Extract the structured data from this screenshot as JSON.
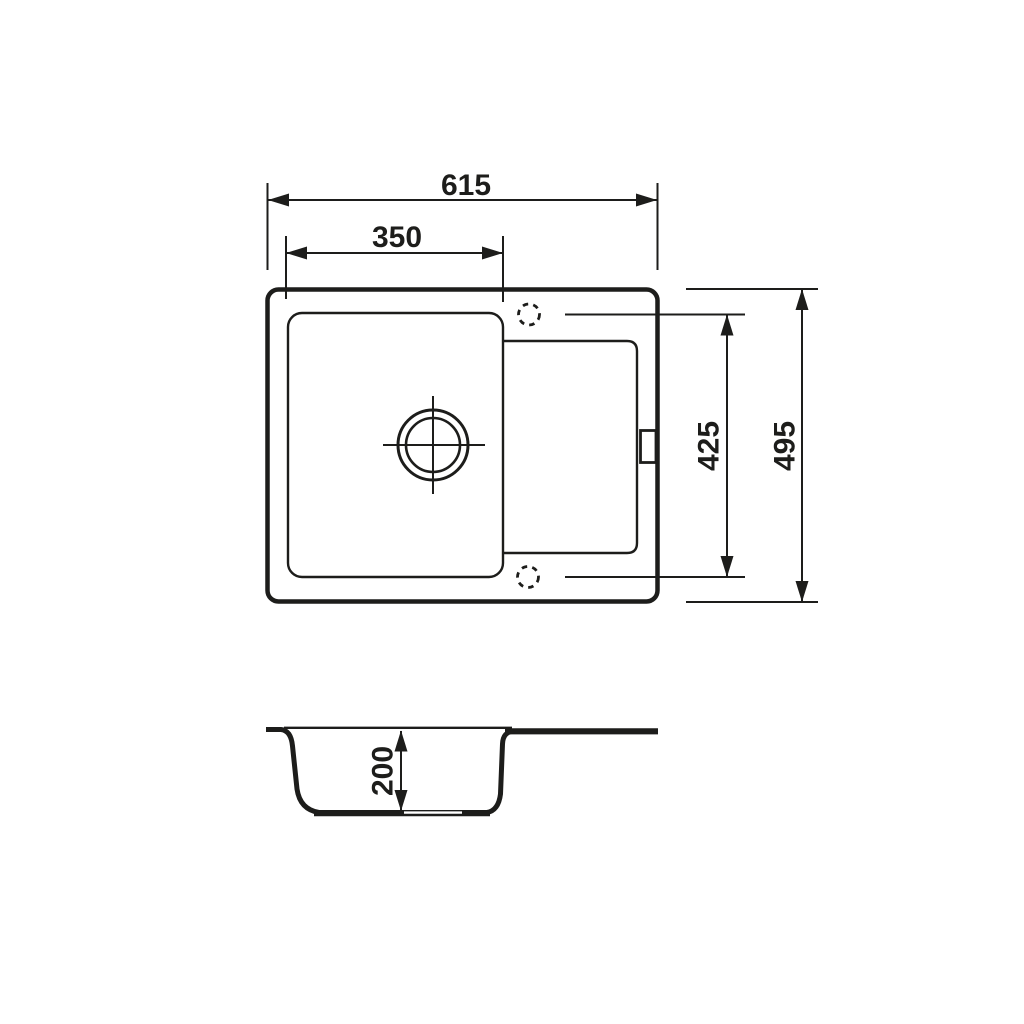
{
  "diagram": {
    "type": "technical-drawing",
    "subject": "kitchen sink with bowl and drainer, dimensioned top view and section view",
    "line_color": "#1d1d1b",
    "background_color": "#ffffff",
    "dimensions": {
      "overall_width": "615",
      "bowl_width": "350",
      "holes_span": "425",
      "overall_depth": "495",
      "bowl_depth": "200"
    }
  }
}
